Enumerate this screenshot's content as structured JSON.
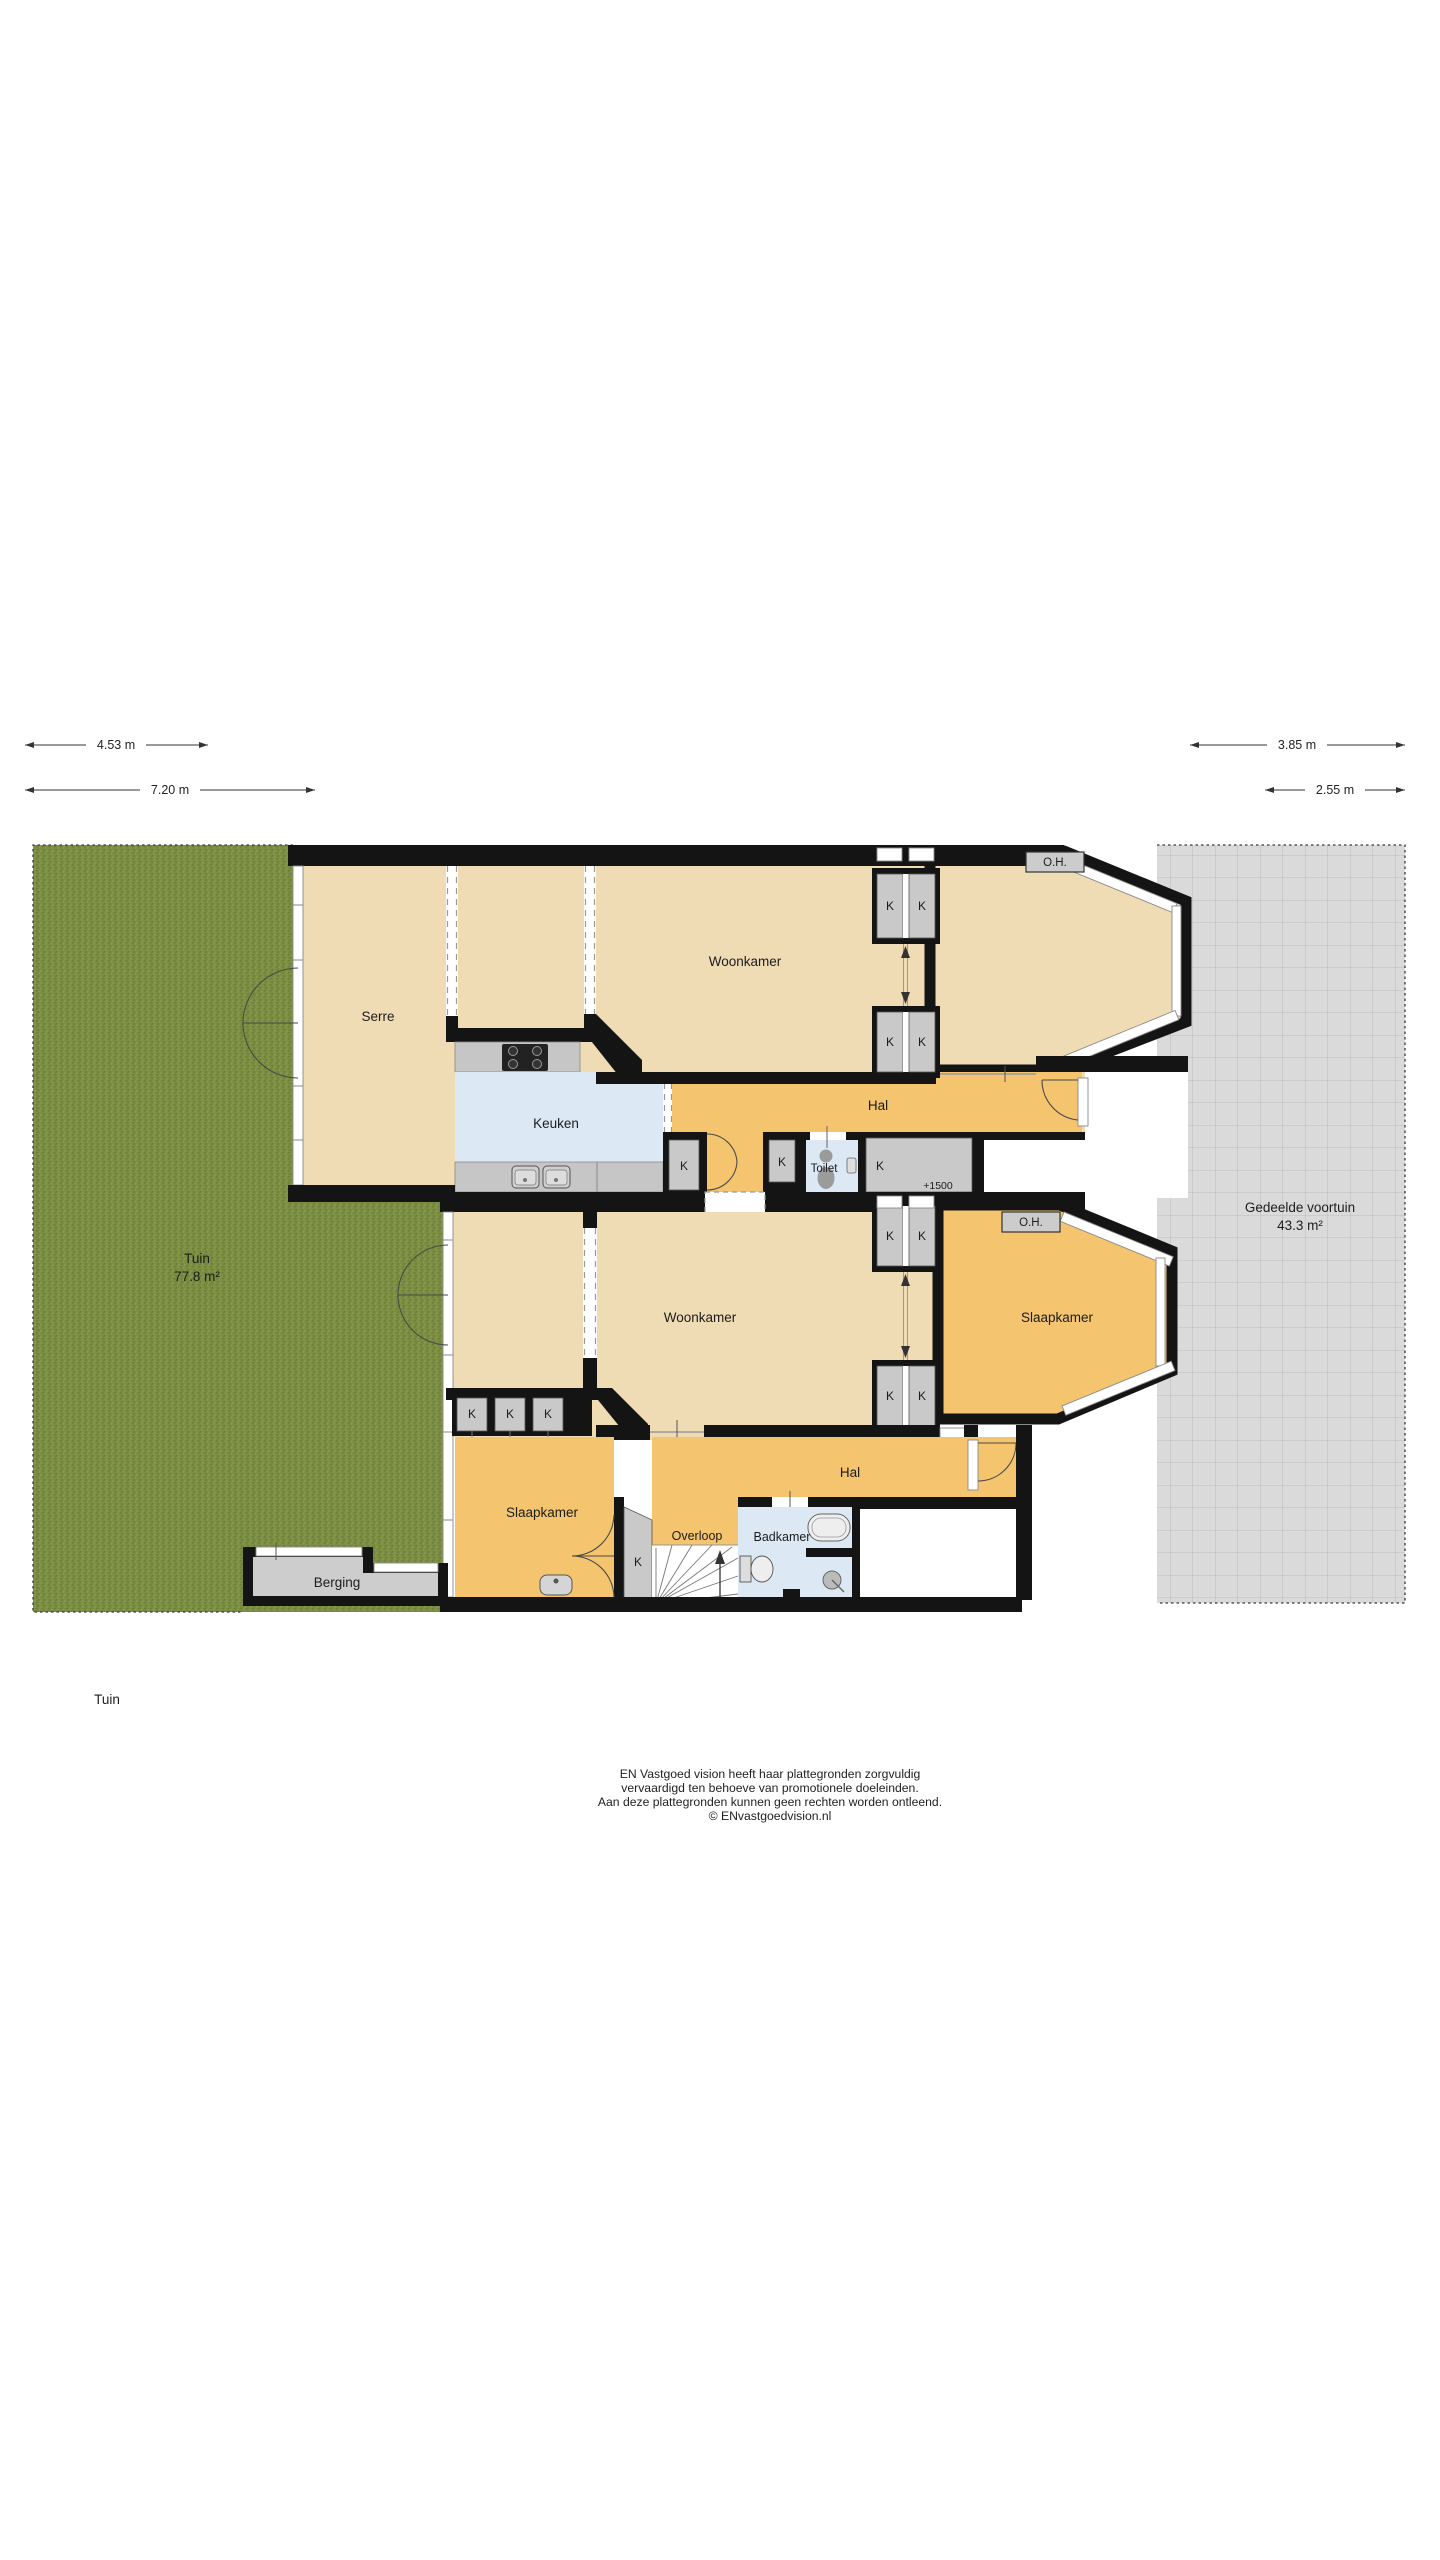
{
  "dims": [
    {
      "label": "4.53 m"
    },
    {
      "label": "7.20 m"
    },
    {
      "label": "3.85 m"
    },
    {
      "label": "2.55 m"
    }
  ],
  "garden": {
    "name": "Tuin",
    "area": "77.8 m²"
  },
  "voortuin": {
    "name": "Gedeelde voortuin",
    "area": "43.3 m²"
  },
  "labels": {
    "closet": "K",
    "level": "+1500",
    "oh": "O.H."
  },
  "rooms_upper": {
    "serre": "Serre",
    "woonkamer": "Woonkamer",
    "keuken": "Keuken",
    "hal": "Hal",
    "toilet": "Toilet"
  },
  "rooms_lower": {
    "woonkamer": "Woonkamer",
    "slaapkamer_right": "Slaapkamer",
    "hal": "Hal",
    "slaapkamer_left": "Slaapkamer",
    "overloop": "Overloop",
    "badkamer": "Badkamer",
    "berging": "Berging"
  },
  "caption": "Tuin",
  "footer": {
    "line1": "EN Vastgoed vision heeft haar plattegronden zorgvuldig",
    "line2": "vervaardigd ten behoeve van promotionele doeleinden.",
    "line3": "Aan deze plattegronden kunnen geen rechten worden ontleend.",
    "line4": "© ENvastgoedvision.nl"
  },
  "colors": {
    "wall": "#141414",
    "room_beige": "#efdbb4",
    "room_orange": "#f4c46f",
    "room_blue": "#dce8f4",
    "room_gray": "#c9c9c9",
    "garden_green": "#7b8e42",
    "voortuin_gray": "#dadada"
  }
}
